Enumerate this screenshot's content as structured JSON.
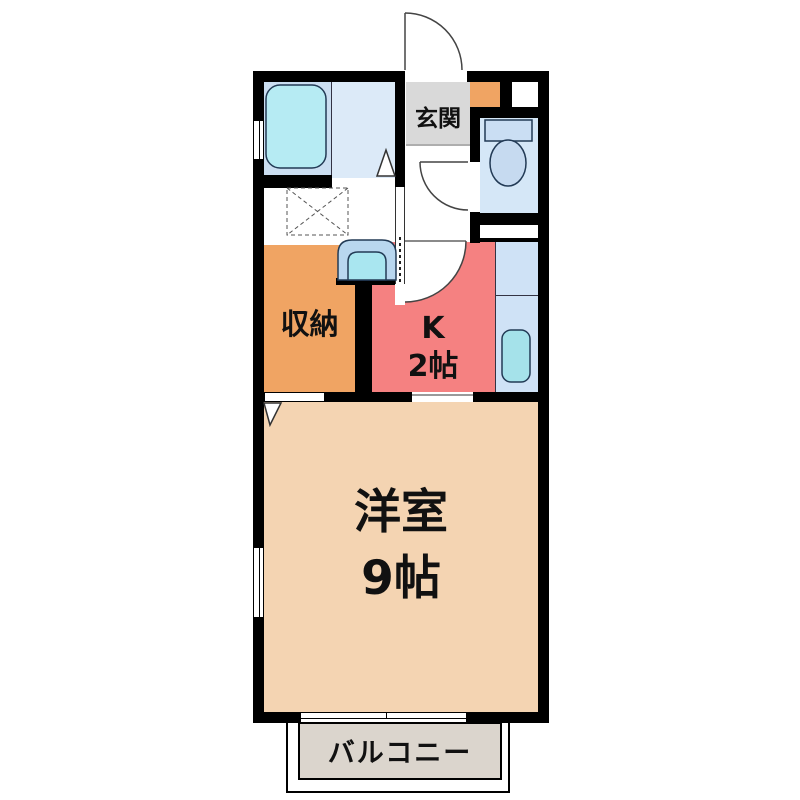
{
  "floorplan": {
    "labels": {
      "entrance": "玄関",
      "storage": "収納",
      "kitchen_line1": "K",
      "kitchen_line2": "2帖",
      "western_room_line1": "洋室",
      "western_room_line2": "9帖",
      "balcony": "バルコニー"
    },
    "colors": {
      "wall": "#000000",
      "western_room": "#f4d4b2",
      "kitchen": "#f58181",
      "storage": "#f0a463",
      "shoe_cabinet": "#f0a463",
      "entrance_floor": "#d9d9d9",
      "balcony": "#dbd5cd",
      "bathroom_left": "#cbdef1",
      "bathroom_right": "#dceaf8",
      "bathtub": "#b6ebf3",
      "toilet_room": "#d5e7f7",
      "toilet_fixture": "#c6daf0",
      "kitchen_counter": "#cfe2f6",
      "kitchen_sink": "#a5e2ea",
      "washbasin_outer": "#b9d7ef",
      "washbasin_bowl": "#a9e6f0"
    },
    "fixtures": [
      "entrance-door-swing",
      "bathtub",
      "bathroom-folding-door",
      "washing-machine-pan",
      "washbasin",
      "toilet",
      "toilet-door-swing",
      "kitchen-door-swing",
      "accordion-door",
      "kitchen-sink",
      "shoe-cabinet",
      "storage-door-marker"
    ]
  }
}
